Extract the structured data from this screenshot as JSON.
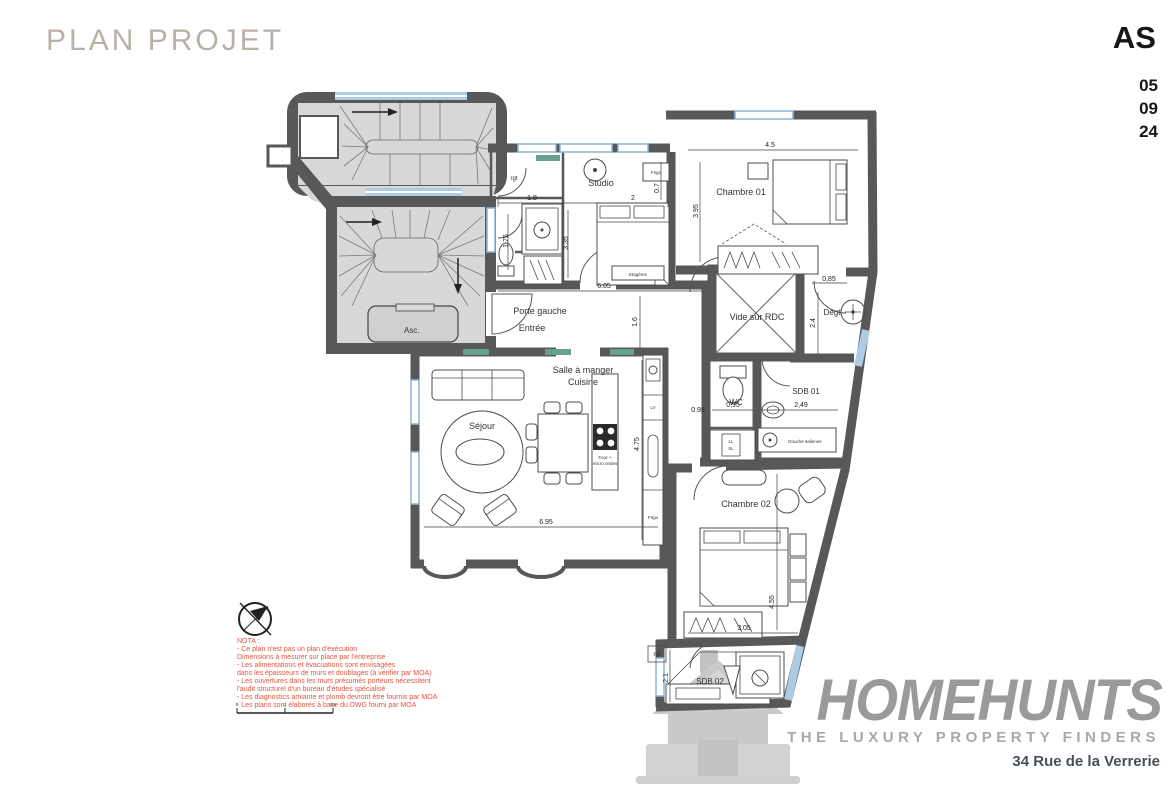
{
  "header": {
    "title": "PLAN PROJET",
    "revision": "AS",
    "date": [
      "05",
      "09",
      "24"
    ]
  },
  "logo": {
    "brand": "HOMEHUNTS",
    "tagline": "THE LUXURY PROPERTY FINDERS",
    "address": "34 Rue de la Verrerie"
  },
  "plan": {
    "rooms": {
      "studio": "Studio",
      "chambre01": "Chambre 01",
      "chambre02": "Chambre 02",
      "sdb01": "SDB 01",
      "sdb02": "SDB 02",
      "wc": "WC",
      "vide_rdc": "Vide sur RDC",
      "degt": "Dégt",
      "sejour": "Séjour",
      "salle_a_manger": "Salle à manger",
      "cuisine": "Cuisine",
      "porte_gauche": "Porte gauche",
      "entree": "Entrée",
      "asc": "Asc."
    },
    "features": {
      "frigo_studio": "Frigo",
      "frigo_cuisine": "Frigo",
      "lv": "LV",
      "four_l1": "Four +",
      "four_l2": "micro ondes",
      "etageres": "Etagères",
      "douche": "Douche italienne",
      "ll": "LL",
      "sl": "SL",
      "rgt_studio": "rgt",
      "rgt_sdb02": "rgt"
    },
    "dims": {
      "w_studio_a": "1.8",
      "w_studio_b": "2",
      "h_studio": "3.35",
      "h_bain": "1.75",
      "w_frigo": "0.7",
      "w_ch01": "4.5",
      "h_ch01": "3.95",
      "w_hall": "6.05",
      "h_hall": "1.6",
      "w_degt": "0,85",
      "h_degt": "2.4",
      "w_wc": "0,95",
      "w_niche": "0.95",
      "w_sdb01": "2,49",
      "h_sejour": "4.75",
      "w_sejour": "6.95",
      "w_ch02": "3.05",
      "h_ch02": "4.55",
      "h_sdb02": "2.1"
    },
    "colors": {
      "wall": "#57585a",
      "window": "#aecbe4",
      "stair_fill": "#d8d8d8",
      "vent": "#69a08b",
      "nota_text": "#e0553f"
    }
  },
  "nota": {
    "lines": [
      "NOTA :",
      "- Ce plan n'est pas un plan d'exécution",
      "Dimensions à mesurer sur place par l'entreprise",
      "- Les alimentations et évacuations sont envisagées",
      "dans les épaisseurs de murs et doublages (à vérifier par MOA)",
      "- Les ouvertures dans les murs présumés porteurs nécessitent",
      "l'audit structurel d'un bureau d'études spécialisé",
      "- Les diagnostics amiante et plomb devront être fournis par MOA",
      "- Les plans sont élaborés à base du DWG fourni par MOA"
    ]
  },
  "scale": {
    "labels": [
      "0",
      "1",
      "2m"
    ]
  }
}
